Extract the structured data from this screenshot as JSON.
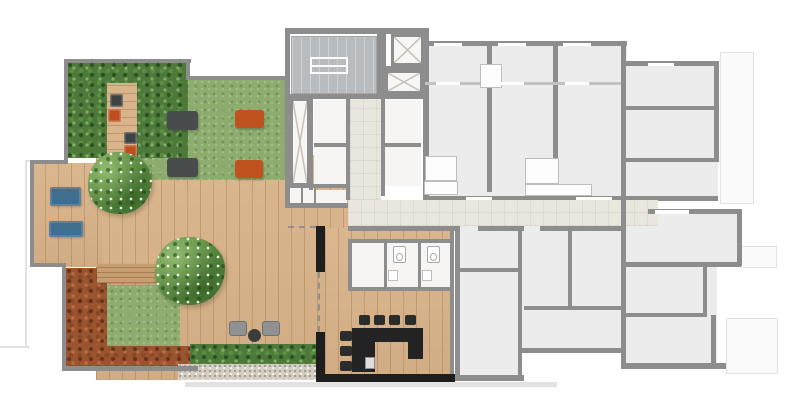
{
  "canvas": {
    "width": 795,
    "height": 413
  },
  "palette": {
    "wall": "#8d8d8d",
    "wallBlack": "#1e1e1e",
    "wood": "#d9b389",
    "woodDark": "#c79e6f",
    "lawn": "#8dac6e",
    "hedge": "#4d7a3a",
    "shrubRed": "#9a5530",
    "gravel": "#d5cfc3",
    "floorUnit": "#ececec",
    "floorCore": "#f6f5f3",
    "corridor": "#e9e6dd",
    "stair": "#b9bcbe",
    "blue": "#3f6e8e",
    "orange": "#c0521f",
    "matDark": "#494c4d",
    "chair": "#8f9193",
    "counter": "#232323"
  },
  "elements": [
    {
      "name": "projection-line-top-left",
      "cls": "thinline",
      "x": 25,
      "y": 160,
      "w": 32,
      "h": 2
    },
    {
      "name": "projection-line-left",
      "cls": "thinline",
      "x": 25,
      "y": 162,
      "w": 2,
      "h": 184
    },
    {
      "name": "projection-line-bottom-left",
      "cls": "thinline",
      "x": 0,
      "y": 346,
      "w": 30,
      "h": 2
    },
    {
      "name": "terrace-shadow-line",
      "cls": "thinline",
      "x": 185,
      "y": 382,
      "w": 372,
      "h": 5
    },
    {
      "name": "balcony-ghost-top-right",
      "cls": "ghost",
      "x": 720,
      "y": 52,
      "w": 34,
      "h": 152
    },
    {
      "name": "balcony-ghost-mid-right",
      "cls": "ghost",
      "x": 740,
      "y": 246,
      "w": 37,
      "h": 22
    },
    {
      "name": "balcony-ghost-bottom-right",
      "cls": "ghost",
      "x": 726,
      "y": 318,
      "w": 52,
      "h": 56
    },
    {
      "name": "unit-floor-north",
      "cls": "floor-unit",
      "x": 425,
      "y": 41,
      "w": 202,
      "h": 159
    },
    {
      "name": "unit-floor-northeast",
      "cls": "floor-unit",
      "x": 627,
      "y": 61,
      "w": 91,
      "h": 139
    },
    {
      "name": "unit-floor-south-a",
      "cls": "floor-unit",
      "x": 455,
      "y": 226,
      "w": 67,
      "h": 152
    },
    {
      "name": "unit-floor-south-b",
      "cls": "floor-unit",
      "x": 522,
      "y": 226,
      "w": 102,
      "h": 126
    },
    {
      "name": "unit-floor-southeast-top",
      "cls": "floor-unit",
      "x": 624,
      "y": 209,
      "w": 116,
      "h": 57
    },
    {
      "name": "unit-floor-southeast-bottom",
      "cls": "floor-unit",
      "x": 624,
      "y": 266,
      "w": 93,
      "h": 100
    },
    {
      "name": "deck-main",
      "cls": "wood",
      "x": 96,
      "y": 155,
      "w": 252,
      "h": 225
    },
    {
      "name": "deck-left-arm",
      "cls": "wood",
      "x": 32,
      "y": 163,
      "w": 70,
      "h": 104
    },
    {
      "name": "gourmet-floor",
      "cls": "wood",
      "x": 325,
      "y": 228,
      "w": 127,
      "h": 152
    },
    {
      "name": "lawn-main",
      "cls": "lawn",
      "x": 137,
      "y": 80,
      "w": 150,
      "h": 100
    },
    {
      "name": "hedge-block-topleft",
      "cls": "hedge",
      "x": 67,
      "y": 62,
      "w": 121,
      "h": 96
    },
    {
      "name": "garden-walkway",
      "cls": "wood-h",
      "x": 107,
      "y": 83,
      "w": 30,
      "h": 75
    },
    {
      "name": "shrub-border-left",
      "cls": "shrub-red",
      "x": 66,
      "y": 268,
      "w": 41,
      "h": 100
    },
    {
      "name": "shrub-border-bottom",
      "cls": "shrub-red",
      "x": 66,
      "y": 346,
      "w": 131,
      "h": 20
    },
    {
      "name": "lawn-patch",
      "cls": "lawn",
      "x": 107,
      "y": 285,
      "w": 73,
      "h": 61
    },
    {
      "name": "garden-bench",
      "cls": "bench",
      "x": 97,
      "y": 264,
      "w": 66,
      "h": 19
    },
    {
      "name": "hedge-strip-bottom",
      "cls": "hedge",
      "x": 190,
      "y": 344,
      "w": 130,
      "h": 20
    },
    {
      "name": "gravel-strip",
      "cls": "gravel",
      "x": 178,
      "y": 364,
      "w": 140,
      "h": 16
    },
    {
      "name": "stair-hall",
      "cls": "stairs",
      "x": 291,
      "y": 36,
      "w": 86,
      "h": 58
    },
    {
      "name": "stair-landing",
      "cls": "landing",
      "x": 310,
      "y": 57,
      "w": 38,
      "h": 17
    },
    {
      "name": "elevator-shaft-1",
      "cls": "shaft",
      "x": 391,
      "y": 34,
      "w": 33,
      "h": 32
    },
    {
      "name": "elevator-shaft-2",
      "cls": "shaft",
      "x": 385,
      "y": 70,
      "w": 38,
      "h": 24
    },
    {
      "name": "service-shaft",
      "cls": "shaft",
      "x": 290,
      "y": 98,
      "w": 20,
      "h": 88
    },
    {
      "name": "core-room-1",
      "cls": "floor-white",
      "x": 314,
      "y": 100,
      "w": 33,
      "h": 43
    },
    {
      "name": "core-room-2",
      "cls": "floor-white",
      "x": 314,
      "y": 147,
      "w": 33,
      "h": 39
    },
    {
      "name": "core-room-3",
      "cls": "floor-white",
      "x": 385,
      "y": 100,
      "w": 36,
      "h": 43
    },
    {
      "name": "core-room-4",
      "cls": "floor-white",
      "x": 385,
      "y": 147,
      "w": 36,
      "h": 39
    },
    {
      "name": "core-room-5",
      "cls": "floor-white",
      "x": 289,
      "y": 188,
      "w": 12,
      "h": 15
    },
    {
      "name": "core-room-6",
      "cls": "floor-white",
      "x": 303,
      "y": 188,
      "w": 11,
      "h": 15
    },
    {
      "name": "core-room-7",
      "cls": "floor-white",
      "x": 316,
      "y": 190,
      "w": 31,
      "h": 14
    },
    {
      "name": "corridor-core",
      "cls": "corridor",
      "x": 350,
      "y": 98,
      "w": 31,
      "h": 102
    },
    {
      "name": "corridor-main",
      "cls": "corridor",
      "x": 348,
      "y": 200,
      "w": 310,
      "h": 26
    },
    {
      "name": "service-room",
      "cls": "floor-white",
      "x": 352,
      "y": 243,
      "w": 32,
      "h": 44
    },
    {
      "name": "wc-1",
      "cls": "floor-white",
      "x": 387,
      "y": 243,
      "w": 31,
      "h": 44
    },
    {
      "name": "wc-2",
      "cls": "floor-white",
      "x": 421,
      "y": 243,
      "w": 31,
      "h": 44
    },
    {
      "name": "wall-hedge-top",
      "cls": "wall",
      "x": 64,
      "y": 59,
      "w": 127,
      "h": 4
    },
    {
      "name": "wall-hedge-left",
      "cls": "wall",
      "x": 64,
      "y": 59,
      "w": 4,
      "h": 102
    },
    {
      "name": "wall-step",
      "cls": "wall",
      "x": 186,
      "y": 61,
      "w": 4,
      "h": 19
    },
    {
      "name": "wall-lawn-top",
      "cls": "wall",
      "x": 188,
      "y": 76,
      "w": 99,
      "h": 4
    },
    {
      "name": "wall-arm-top",
      "cls": "wall",
      "x": 30,
      "y": 160,
      "w": 38,
      "h": 4
    },
    {
      "name": "wall-arm-left",
      "cls": "wall",
      "x": 30,
      "y": 160,
      "w": 4,
      "h": 107
    },
    {
      "name": "wall-arm-bottom",
      "cls": "wall",
      "x": 30,
      "y": 263,
      "w": 36,
      "h": 4
    },
    {
      "name": "wall-shrub-left",
      "cls": "wall",
      "x": 62,
      "y": 265,
      "w": 4,
      "h": 103
    },
    {
      "name": "wall-shrub-bottom",
      "cls": "wall",
      "x": 62,
      "y": 366,
      "w": 136,
      "h": 5
    },
    {
      "name": "wall-core-top",
      "cls": "wall",
      "x": 285,
      "y": 28,
      "w": 144,
      "h": 6
    },
    {
      "name": "wall-core-left",
      "cls": "wall",
      "x": 285,
      "y": 28,
      "w": 5,
      "h": 177
    },
    {
      "name": "wall-core-right",
      "cls": "wall",
      "x": 423,
      "y": 28,
      "w": 6,
      "h": 168
    },
    {
      "name": "wall-stairs-south",
      "cls": "wall",
      "x": 289,
      "y": 94,
      "w": 140,
      "h": 5
    },
    {
      "name": "wall-stairs-shaft",
      "cls": "wall",
      "x": 377,
      "y": 32,
      "w": 9,
      "h": 62
    },
    {
      "name": "wall-shaft-divider",
      "cls": "wall",
      "x": 385,
      "y": 66,
      "w": 39,
      "h": 4
    },
    {
      "name": "wall-core-a",
      "cls": "wall",
      "x": 309,
      "y": 98,
      "w": 4,
      "h": 92
    },
    {
      "name": "wall-corridor-west",
      "cls": "wall",
      "x": 346,
      "y": 98,
      "w": 4,
      "h": 102
    },
    {
      "name": "wall-corridor-east",
      "cls": "wall",
      "x": 381,
      "y": 98,
      "w": 4,
      "h": 98
    },
    {
      "name": "wall-core-b",
      "cls": "wall",
      "x": 314,
      "y": 143,
      "w": 33,
      "h": 4
    },
    {
      "name": "wall-core-c",
      "cls": "wall",
      "x": 385,
      "y": 143,
      "w": 36,
      "h": 4
    },
    {
      "name": "wall-core-d",
      "cls": "wall",
      "x": 285,
      "y": 184,
      "w": 62,
      "h": 4
    },
    {
      "name": "wall-core-e",
      "cls": "wall",
      "x": 285,
      "y": 203,
      "w": 63,
      "h": 5
    },
    {
      "name": "wall-core-f",
      "cls": "wall",
      "x": 301,
      "y": 188,
      "w": 2,
      "h": 15
    },
    {
      "name": "wall-core-g",
      "cls": "wall",
      "x": 314,
      "y": 188,
      "w": 2,
      "h": 16
    },
    {
      "name": "wall-rw-top",
      "cls": "wall",
      "x": 423,
      "y": 41,
      "w": 204,
      "h": 5
    },
    {
      "name": "wall-rw-v1",
      "cls": "wall",
      "x": 487,
      "y": 44,
      "w": 5,
      "h": 148
    },
    {
      "name": "wall-rw-v2",
      "cls": "wall",
      "x": 553,
      "y": 44,
      "w": 5,
      "h": 148
    },
    {
      "name": "wall-rw-v3",
      "cls": "wall",
      "x": 621,
      "y": 41,
      "w": 5,
      "h": 170
    },
    {
      "name": "wall-balcony-divider",
      "cls": "wall-light",
      "x": 425,
      "y": 82,
      "w": 196,
      "h": 3
    },
    {
      "name": "wall-corridor-north",
      "cls": "wall",
      "x": 423,
      "y": 196,
      "w": 237,
      "h": 4
    },
    {
      "name": "wall-ne-top",
      "cls": "wall",
      "x": 626,
      "y": 61,
      "w": 93,
      "h": 5
    },
    {
      "name": "wall-ne-right",
      "cls": "wall",
      "x": 714,
      "y": 61,
      "w": 5,
      "h": 100
    },
    {
      "name": "wall-ne-p1",
      "cls": "wall",
      "x": 626,
      "y": 106,
      "w": 90,
      "h": 4
    },
    {
      "name": "wall-ne-p2",
      "cls": "wall",
      "x": 626,
      "y": 158,
      "w": 93,
      "h": 4
    },
    {
      "name": "wall-ne-south",
      "cls": "wall",
      "x": 658,
      "y": 196,
      "w": 60,
      "h": 5
    },
    {
      "name": "wall-corridor-south-1",
      "cls": "wall",
      "x": 348,
      "y": 226,
      "w": 110,
      "h": 5
    },
    {
      "name": "wall-corridor-south-2",
      "cls": "wall",
      "x": 478,
      "y": 226,
      "w": 46,
      "h": 5
    },
    {
      "name": "wall-corridor-south-3",
      "cls": "wall",
      "x": 540,
      "y": 226,
      "w": 86,
      "h": 5
    },
    {
      "name": "wall-ua-west",
      "cls": "wall",
      "x": 455,
      "y": 226,
      "w": 5,
      "h": 154
    },
    {
      "name": "wall-ua-east",
      "cls": "wall",
      "x": 518,
      "y": 231,
      "w": 4,
      "h": 149
    },
    {
      "name": "wall-ua-bottom",
      "cls": "wall",
      "x": 452,
      "y": 375,
      "w": 72,
      "h": 6
    },
    {
      "name": "wall-ua-partition",
      "cls": "wall",
      "x": 455,
      "y": 268,
      "w": 65,
      "h": 4
    },
    {
      "name": "wall-ub-bottom",
      "cls": "wall",
      "x": 522,
      "y": 348,
      "w": 104,
      "h": 5
    },
    {
      "name": "wall-ub-v",
      "cls": "wall",
      "x": 568,
      "y": 230,
      "w": 4,
      "h": 80
    },
    {
      "name": "wall-ub-partition",
      "cls": "wall",
      "x": 524,
      "y": 306,
      "w": 100,
      "h": 4
    },
    {
      "name": "wall-se-west",
      "cls": "wall",
      "x": 621,
      "y": 209,
      "w": 5,
      "h": 160
    },
    {
      "name": "wall-se-north",
      "cls": "wall",
      "x": 648,
      "y": 209,
      "w": 94,
      "h": 5
    },
    {
      "name": "wall-se-east-top",
      "cls": "wall",
      "x": 737,
      "y": 209,
      "w": 5,
      "h": 57
    },
    {
      "name": "wall-se-p1",
      "cls": "wall",
      "x": 626,
      "y": 262,
      "w": 115,
      "h": 5
    },
    {
      "name": "wall-se-p2",
      "cls": "wall",
      "x": 703,
      "y": 267,
      "w": 4,
      "h": 50
    },
    {
      "name": "wall-se-p3",
      "cls": "wall",
      "x": 711,
      "y": 315,
      "w": 5,
      "h": 53
    },
    {
      "name": "wall-se-p4",
      "cls": "wall",
      "x": 626,
      "y": 313,
      "w": 80,
      "h": 4
    },
    {
      "name": "wall-se-bottom",
      "cls": "wall",
      "x": 621,
      "y": 363,
      "w": 105,
      "h": 6
    },
    {
      "name": "wall-wc-top",
      "cls": "wall",
      "x": 350,
      "y": 239,
      "w": 104,
      "h": 4
    },
    {
      "name": "wall-wc-d1",
      "cls": "wall",
      "x": 384,
      "y": 243,
      "w": 3,
      "h": 44
    },
    {
      "name": "wall-wc-d2",
      "cls": "wall",
      "x": 418,
      "y": 243,
      "w": 3,
      "h": 44
    },
    {
      "name": "wall-wc-bottom",
      "cls": "wall",
      "x": 350,
      "y": 287,
      "w": 104,
      "h": 4
    },
    {
      "name": "wall-wc-west",
      "cls": "wall",
      "x": 348,
      "y": 239,
      "w": 4,
      "h": 52
    },
    {
      "name": "wall-gourmet-east",
      "cls": "wall",
      "x": 450,
      "y": 231,
      "w": 4,
      "h": 150
    },
    {
      "name": "wall-black-upper",
      "cls": "wall-black",
      "x": 316,
      "y": 226,
      "w": 9,
      "h": 46
    },
    {
      "name": "wall-black-lower",
      "cls": "wall-black",
      "x": 316,
      "y": 332,
      "w": 9,
      "h": 50
    },
    {
      "name": "wall-black-bottom",
      "cls": "wall-black",
      "x": 316,
      "y": 374,
      "w": 139,
      "h": 8
    },
    {
      "name": "opening-dashed-v",
      "cls": "dashed-v",
      "x": 318,
      "y": 272,
      "w": 2,
      "h": 60
    },
    {
      "name": "opening-dashed-h",
      "cls": "dashed-h",
      "x": 288,
      "y": 226,
      "w": 28,
      "h": 2
    },
    {
      "name": "bar-counter-top",
      "cls": "counter",
      "x": 352,
      "y": 328,
      "w": 71,
      "h": 14
    },
    {
      "name": "bar-counter-left",
      "cls": "counter",
      "x": 352,
      "y": 342,
      "w": 23,
      "h": 30
    },
    {
      "name": "bar-counter-right",
      "cls": "counter",
      "x": 408,
      "y": 342,
      "w": 15,
      "h": 17
    },
    {
      "name": "bar-appliance",
      "cls": "appliance",
      "x": 365,
      "y": 357,
      "w": 10,
      "h": 12
    },
    {
      "name": "bar-stool",
      "cls": "stool",
      "x": 359,
      "y": 315,
      "w": 11,
      "h": 10
    },
    {
      "name": "bar-stool",
      "cls": "stool",
      "x": 374,
      "y": 315,
      "w": 11,
      "h": 10
    },
    {
      "name": "bar-stool",
      "cls": "stool",
      "x": 389,
      "y": 315,
      "w": 11,
      "h": 10
    },
    {
      "name": "bar-stool",
      "cls": "stool",
      "x": 405,
      "y": 315,
      "w": 11,
      "h": 10
    },
    {
      "name": "bar-stool",
      "cls": "stool",
      "x": 340,
      "y": 331,
      "w": 12,
      "h": 10
    },
    {
      "name": "bar-stool",
      "cls": "stool",
      "x": 340,
      "y": 346,
      "w": 12,
      "h": 10
    },
    {
      "name": "bar-stool",
      "cls": "stool",
      "x": 340,
      "y": 361,
      "w": 12,
      "h": 10
    },
    {
      "name": "toilet",
      "cls": "toilet",
      "x": 393,
      "y": 246,
      "w": 13,
      "h": 17
    },
    {
      "name": "toilet",
      "cls": "toilet",
      "x": 427,
      "y": 246,
      "w": 13,
      "h": 17
    },
    {
      "name": "sink",
      "cls": "fixture",
      "x": 388,
      "y": 270,
      "w": 10,
      "h": 11
    },
    {
      "name": "sink",
      "cls": "fixture",
      "x": 422,
      "y": 270,
      "w": 10,
      "h": 11
    },
    {
      "name": "bath-pod",
      "cls": "fixture",
      "x": 425,
      "y": 156,
      "w": 32,
      "h": 25
    },
    {
      "name": "kitchen-counter",
      "cls": "fixture",
      "x": 424,
      "y": 181,
      "w": 34,
      "h": 14
    },
    {
      "name": "bath-pod",
      "cls": "fixture",
      "x": 525,
      "y": 158,
      "w": 34,
      "h": 26
    },
    {
      "name": "kitchen-counter",
      "cls": "fixture",
      "x": 525,
      "y": 184,
      "w": 67,
      "h": 12
    },
    {
      "name": "wardrobe",
      "cls": "fixture",
      "x": 480,
      "y": 64,
      "w": 22,
      "h": 24
    },
    {
      "name": "lounge-mat-dark",
      "cls": "mat-dark",
      "x": 167,
      "y": 111,
      "w": 31,
      "h": 19
    },
    {
      "name": "lounge-mat-orange",
      "cls": "mat-orange",
      "x": 235,
      "y": 110,
      "w": 29,
      "h": 18
    },
    {
      "name": "lounge-mat-dark",
      "cls": "mat-dark",
      "x": 167,
      "y": 158,
      "w": 31,
      "h": 19
    },
    {
      "name": "lounge-mat-orange",
      "cls": "mat-orange",
      "x": 235,
      "y": 160,
      "w": 28,
      "h": 18
    },
    {
      "name": "walkway-cushion-dark",
      "cls": "cushion-dark",
      "x": 110,
      "y": 94,
      "w": 13,
      "h": 13
    },
    {
      "name": "walkway-cushion-orange",
      "cls": "cushion-orange",
      "x": 108,
      "y": 109,
      "w": 13,
      "h": 13
    },
    {
      "name": "walkway-cushion-dark",
      "cls": "cushion-dark",
      "x": 124,
      "y": 132,
      "w": 13,
      "h": 12
    },
    {
      "name": "walkway-cushion-orange",
      "cls": "cushion-orange",
      "x": 124,
      "y": 145,
      "w": 13,
      "h": 12
    },
    {
      "name": "sun-lounger-blue",
      "cls": "lounger",
      "x": 50,
      "y": 187,
      "w": 31,
      "h": 19
    },
    {
      "name": "sun-lounger-blue",
      "cls": "lounger",
      "x": 49,
      "y": 221,
      "w": 34,
      "h": 16
    },
    {
      "name": "armchair",
      "cls": "chair",
      "x": 229,
      "y": 321,
      "w": 18,
      "h": 15
    },
    {
      "name": "armchair",
      "cls": "chair",
      "x": 262,
      "y": 321,
      "w": 18,
      "h": 15
    },
    {
      "name": "side-table",
      "cls": "table-round",
      "x": 248,
      "y": 329,
      "w": 13,
      "h": 13
    },
    {
      "name": "tree",
      "cls": "tree",
      "x": 88,
      "y": 152,
      "w": 64,
      "h": 62
    },
    {
      "name": "tree",
      "cls": "tree",
      "x": 155,
      "y": 237,
      "w": 70,
      "h": 68
    },
    {
      "name": "window",
      "cls": "window-lite",
      "x": 434,
      "y": 43,
      "w": 28,
      "h": 3
    },
    {
      "name": "window",
      "cls": "window-lite",
      "x": 498,
      "y": 43,
      "w": 28,
      "h": 3
    },
    {
      "name": "window",
      "cls": "window-lite",
      "x": 563,
      "y": 43,
      "w": 28,
      "h": 3
    },
    {
      "name": "window",
      "cls": "window-lite",
      "x": 648,
      "y": 63,
      "w": 26,
      "h": 3
    },
    {
      "name": "window",
      "cls": "window-lite",
      "x": 466,
      "y": 197,
      "w": 26,
      "h": 3
    },
    {
      "name": "window",
      "cls": "window-lite",
      "x": 576,
      "y": 197,
      "w": 36,
      "h": 3
    },
    {
      "name": "window",
      "cls": "window-lite",
      "x": 655,
      "y": 210,
      "w": 34,
      "h": 4
    },
    {
      "name": "window",
      "cls": "window-lite",
      "x": 436,
      "y": 82,
      "w": 24,
      "h": 3
    },
    {
      "name": "window",
      "cls": "window-lite",
      "x": 500,
      "y": 82,
      "w": 24,
      "h": 3
    },
    {
      "name": "window",
      "cls": "window-lite",
      "x": 565,
      "y": 82,
      "w": 24,
      "h": 3
    }
  ]
}
